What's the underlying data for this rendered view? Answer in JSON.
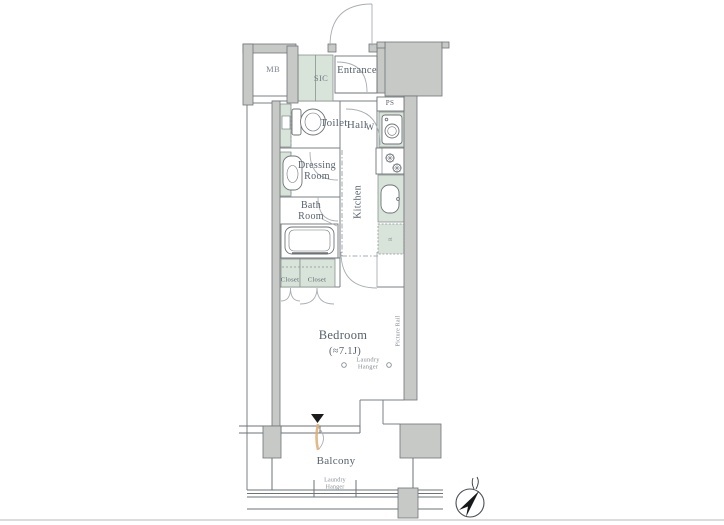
{
  "plan": {
    "rooms": {
      "mb": "MB",
      "sic": "SIC",
      "entrance": "Entrance",
      "ps": "PS",
      "washer": "W",
      "toilet": "Toilet",
      "hall": "Hall",
      "dressing_room": "Dressing Room",
      "kitchen": "Kitchen",
      "bath_room": "Bath Room",
      "closet_left": "Closet",
      "closet_right": "Closet",
      "bedroom": "Bedroom",
      "bedroom_size": "(≈7.1J)",
      "balcony": "Balcony"
    },
    "annotations": {
      "picture_rail": "Picture Rail",
      "laundry_hanger_bedroom": "Laundry Hanger",
      "laundry_hanger_balcony": "Laundry Hanger",
      "fridge": "R"
    },
    "colors": {
      "wall_fill": "#c7c9c7",
      "fixture_green": "#d8e3d9",
      "line": "#6e7377",
      "text": "#57616c",
      "text_small": "#878e96",
      "accent_orange": "#ddad72"
    }
  }
}
